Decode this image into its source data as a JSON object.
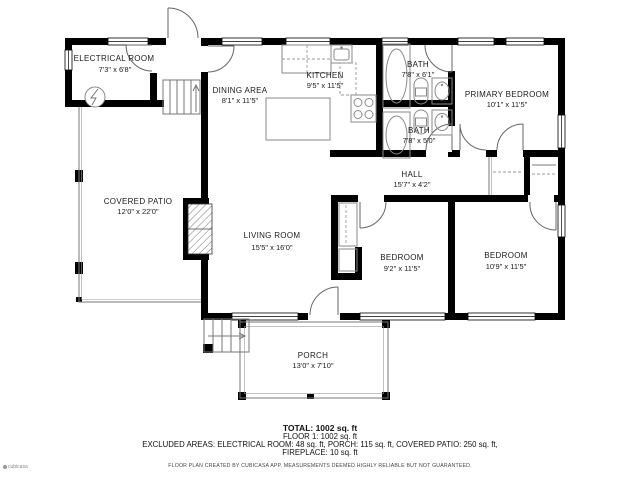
{
  "rooms": {
    "electrical": {
      "name": "ELECTRICAL ROOM",
      "dims": "7'3\" x 6'8\""
    },
    "dining": {
      "name": "DINING AREA",
      "dims": "8'1\" x 11'5\""
    },
    "kitchen": {
      "name": "KITCHEN",
      "dims": "9'5\" x 11'5\""
    },
    "bath1": {
      "name": "BATH",
      "dims": "7'8\" x 6'1\""
    },
    "bath2": {
      "name": "BATH",
      "dims": "7'8\" x 5'0\""
    },
    "primary_bedroom": {
      "name": "PRIMARY BEDROOM",
      "dims": "10'1\" x 11'5\""
    },
    "hall": {
      "name": "HALL",
      "dims": "15'7\" x 4'2\""
    },
    "covered_patio": {
      "name": "COVERED PATIO",
      "dims": "12'0\" x 22'0\""
    },
    "living_room": {
      "name": "LIVING ROOM",
      "dims": "15'5\" x 16'0\""
    },
    "bedroom_mid": {
      "name": "BEDROOM",
      "dims": "9'2\" x 11'5\""
    },
    "bedroom_right": {
      "name": "BEDROOM",
      "dims": "10'9\" x 11'5\""
    },
    "porch": {
      "name": "PORCH",
      "dims": "13'0\" x 7'10\""
    }
  },
  "summary": {
    "total": "TOTAL: 1002 sq. ft",
    "floor1": "FLOOR 1: 1002 sq. ft",
    "excluded_line1": "EXCLUDED AREAS: ELECTRICAL ROOM: 48 sq. ft, PORCH: 115 sq. ft, COVERED PATIO: 250 sq. ft,",
    "excluded_line2": "FIREPLACE: 10 sq. ft",
    "disclaimer": "FLOOR PLAN CREATED BY CUBICASA APP. MEASUREMENTS DEEMED HIGHLY RELIABLE BUT NOT GUARANTEED."
  },
  "watermark": {
    "text": "cubicasa"
  },
  "colors": {
    "wall": "#000000",
    "background": "#ffffff",
    "label_text": "#1a1a1a",
    "fixture_line": "#8a8a8a"
  }
}
